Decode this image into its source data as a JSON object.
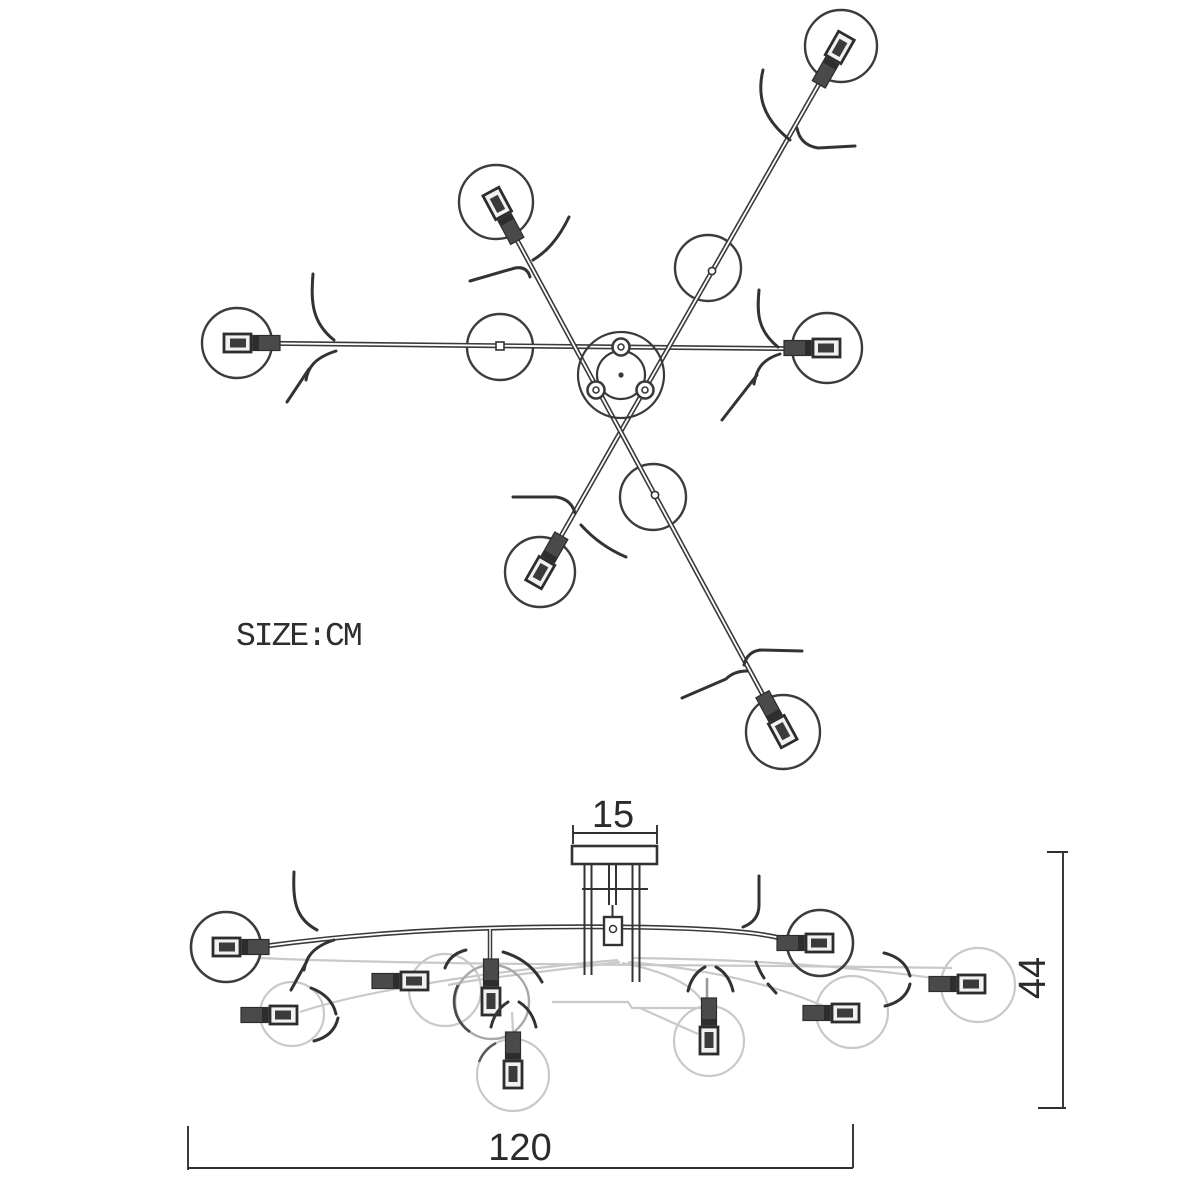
{
  "labels": {
    "size_unit": "SIZE:CM"
  },
  "dimensions": {
    "canopy_width_cm": "15",
    "height_cm": "44",
    "width_cm": "120"
  },
  "colors": {
    "ink": "#3a3a3a",
    "socket_fill": "#474747",
    "faint": "#c9c9c9",
    "background": "#ffffff"
  }
}
